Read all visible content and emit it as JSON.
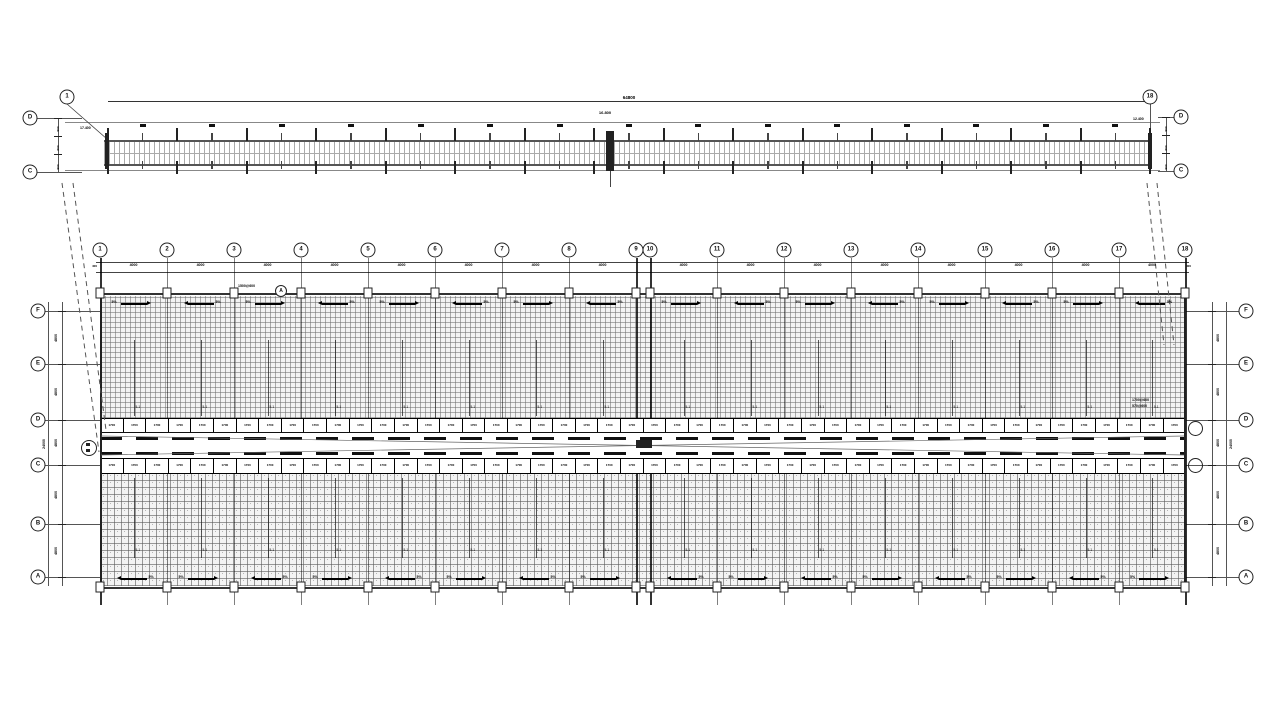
{
  "strip": {
    "bubble_start": "1",
    "bubble_end": "18",
    "row_top": "D",
    "row_bottom": "C",
    "overall_dim": "64800",
    "level_joint": "16.800",
    "level_left": "17.400",
    "level_right": "12.400",
    "side_dims": [
      "900",
      "600",
      "900"
    ]
  },
  "plan": {
    "columns": [
      "1",
      "2",
      "3",
      "4",
      "5",
      "6",
      "7",
      "8",
      "9",
      "10",
      "11",
      "12",
      "13",
      "14",
      "15",
      "16",
      "17",
      "18"
    ],
    "bay_dim": "4000",
    "edge_dim": "400",
    "rows": [
      "F",
      "E",
      "D",
      "C",
      "B",
      "A"
    ],
    "gap_dim": "4800",
    "overall_dim": "24000",
    "chain_value": "1700",
    "chain_count": 48,
    "slope_label": "5%",
    "purlin_tag": "5-1",
    "callout_col3": {
      "text": "1500@600",
      "bubble": "A"
    },
    "callout_right": {
      "line1": "1700@600",
      "line2": "570@600"
    }
  }
}
